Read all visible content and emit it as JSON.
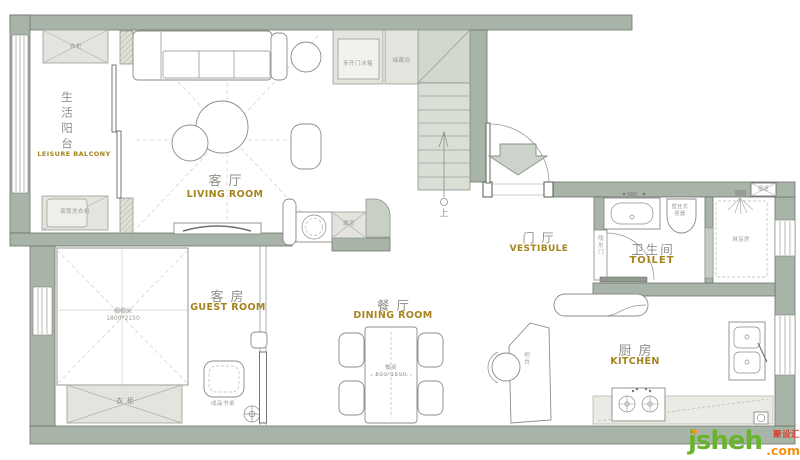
{
  "rooms": {
    "balcony": {
      "zh": "生活阳台",
      "en": "LEISURE BALCONY"
    },
    "living": {
      "zh": "客厅",
      "en": "LIVING ROOM"
    },
    "guest": {
      "zh": "客房",
      "en": "GUEST ROOM"
    },
    "dining": {
      "zh": "餐厅",
      "en": "DINING ROOM"
    },
    "vestibule": {
      "zh": "门厅",
      "en": "VESTIBULE"
    },
    "toilet": {
      "zh": "卫生间",
      "en": "TOILET"
    },
    "kitchen": {
      "zh": "厨房",
      "en": "KITCHEN"
    }
  },
  "annotations": {
    "balcony_wardrobe": "衣柜",
    "washing_machine": "滚筒洗衣机",
    "fridge": "多开门冰箱",
    "storage_room": "储藏间",
    "stairs_up": "上",
    "flue_living": "烟道",
    "hidden_door": "隐形门",
    "wall_hung_toilet": "壁挂式便器",
    "shower_room": "淋浴房",
    "flue_wall": "烟道",
    "tatami": "榻榻米",
    "tatami_size": "1800*2150",
    "guest_wardrobe": "衣柜",
    "desk": "成品书桌",
    "dining_table": "餐桌",
    "dining_table_size": "800*1500",
    "bar_counter": "吧台"
  },
  "watermark": {
    "brand": "jsheh",
    "suffix": ".com",
    "cn": "聚设汇"
  },
  "colors": {
    "wall": "#a8b4a8",
    "accent_gold": "#a6831d",
    "label_gray": "#909089",
    "tiny_gray": "#9b9b95",
    "watermark_green": "#6ab42d",
    "watermark_orange": "#f39119",
    "watermark_red": "#d9402e"
  }
}
